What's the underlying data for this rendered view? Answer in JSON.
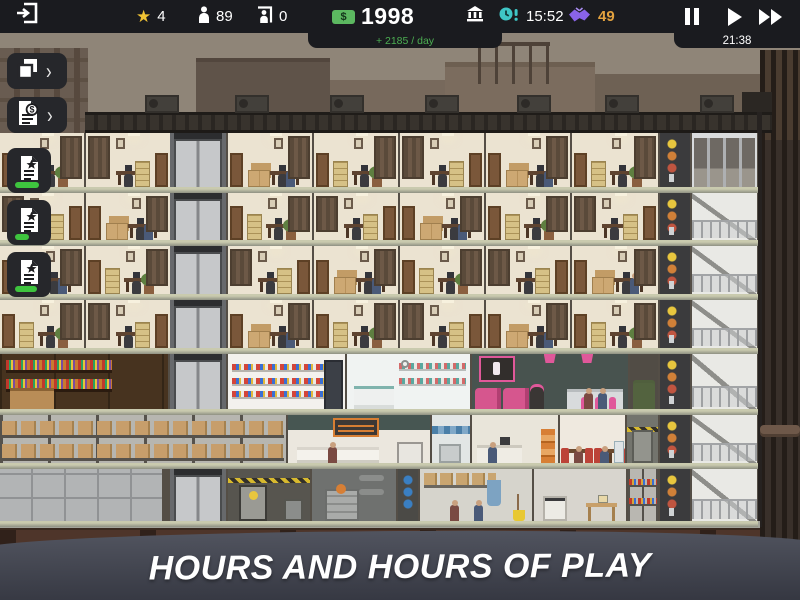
{
  "topbar": {
    "rating": "4",
    "workers": "89",
    "visitors": "0",
    "currency_symbol": "$",
    "money": "1998",
    "income_per_day": "+ 2185 / day",
    "deadline_time": "15:52",
    "deals": "49",
    "local_time": "21:38"
  },
  "sidebar": {
    "chevron": "›",
    "buttons": [
      {
        "id": "view-layers",
        "icon": "copy-icon",
        "has_chevron": true
      },
      {
        "id": "finance-report",
        "icon": "document-dollar-icon",
        "has_chevron": true
      },
      {
        "id": "active-project-1",
        "icon": "document-star-icon",
        "progress": 80
      },
      {
        "id": "active-project-2",
        "icon": "document-star-icon",
        "progress": 45
      },
      {
        "id": "active-project-3",
        "icon": "document-star-icon",
        "progress": 72
      }
    ]
  },
  "banner": {
    "text": "HOURS AND HOURS OF PLAY"
  },
  "colors": {
    "topbar_bg": "#1a1b1f",
    "accent_green": "#4cae52",
    "money_badge_green": "#5cb860",
    "star_yellow": "#f0c334",
    "deadline_teal": "#3fc6c6",
    "deals_purple": "#8a63e8",
    "deals_orange": "#e3a23f",
    "progress_green": "#3ec43e",
    "banner_bg": "#3d404d"
  }
}
